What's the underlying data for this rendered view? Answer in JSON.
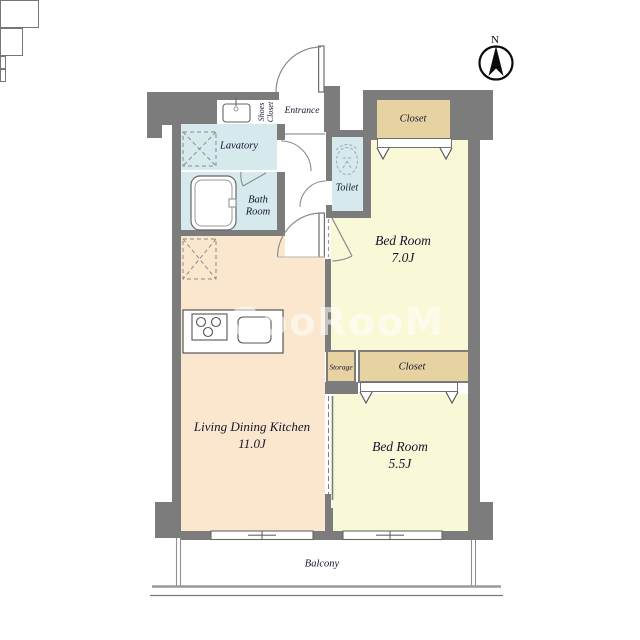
{
  "compass": {
    "label": "N"
  },
  "watermark": {
    "text": "GooRooM"
  },
  "colors": {
    "wall": "#7c7c7c",
    "water_room": "#d6e9ec",
    "bedroom": "#f9f9d7",
    "ldk": "#fbe7cd",
    "closet": "#e7d2a2",
    "line": "#707070",
    "label_text": "#14142e"
  },
  "rooms": {
    "entrance": {
      "label": "Entrance"
    },
    "shoes_closet": {
      "label": "Shoes Closet"
    },
    "lavatory": {
      "label": "Lavatory"
    },
    "bath_room": {
      "label": "Bath Room"
    },
    "toilet": {
      "label": "Toilet"
    },
    "closet_top": {
      "label": "Closet"
    },
    "bedroom_7": {
      "name": "Bed Room",
      "size": "7.0J"
    },
    "storage": {
      "label": "Storage"
    },
    "closet_mid": {
      "label": "Closet"
    },
    "bedroom_5": {
      "name": "Bed Room",
      "size": "5.5J"
    },
    "ldk": {
      "name": "Living Dining Kitchen",
      "size": "11.0J"
    },
    "balcony": {
      "label": "Balcony"
    }
  }
}
